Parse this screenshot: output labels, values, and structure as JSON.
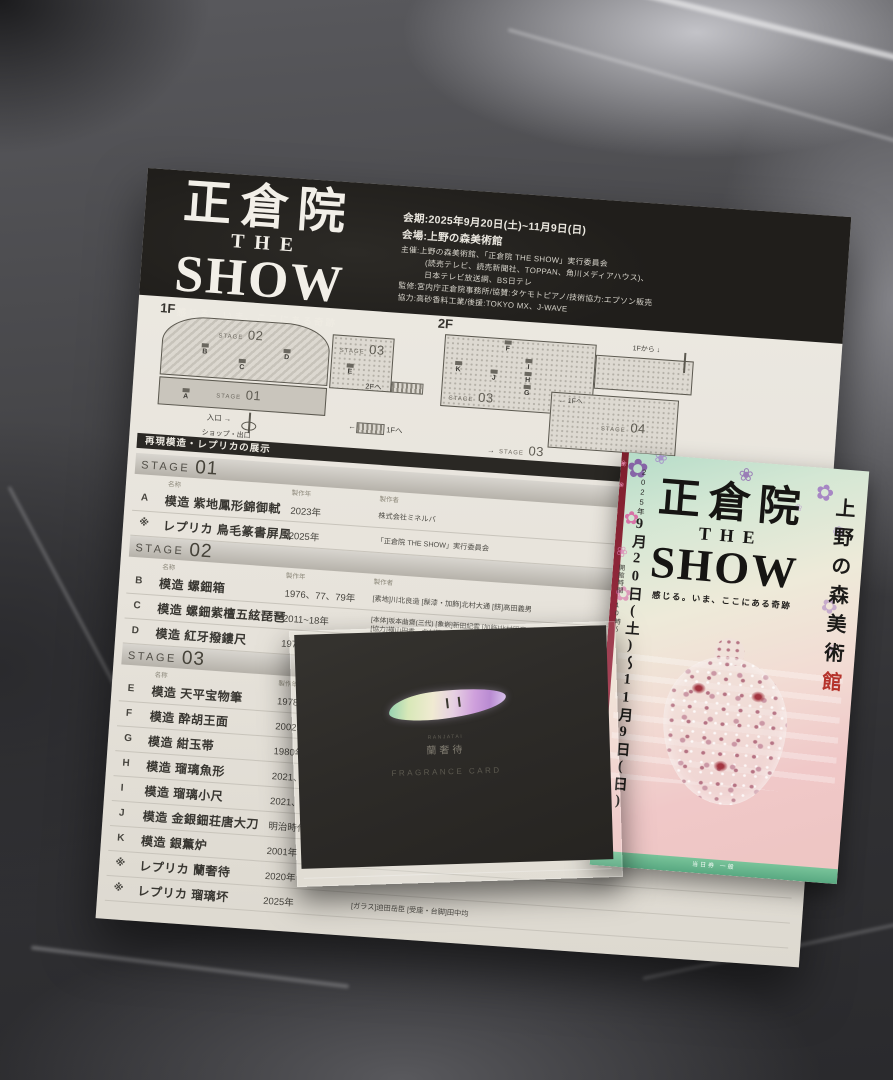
{
  "flyer": {
    "title": {
      "line1": "正倉院",
      "line2": "THE",
      "line3": "SHOW",
      "tagline": "感じる。いま、ここにある奇跡"
    },
    "info": {
      "lines": [
        "会期:2025年9月20日(土)~11月9日(日)",
        "会場:上野の森美術館",
        "主催:上野の森美術館、「正倉院 THE SHOW」実行委員会",
        "(読売テレビ、読売新聞社、TOPPAN、角川メディアハウス)、",
        "日本テレビ放送網、BS日テレ",
        "監修:宮内庁正倉院事務所/協賛:タケモトピアノ/技術協力:エプソン販売",
        "協力:高砂香料工業/後援:TOKYO MX、J-WAVE"
      ]
    },
    "floorplan": {
      "f1": "1F",
      "f2": "2F",
      "stage_word": "STAGE",
      "s01": "01",
      "s02": "02",
      "s03": "03",
      "s04": "04",
      "entrance": "入口",
      "shop_exit": "ショップ・出口",
      "to_2f": "2Fへ",
      "to_1f": "1Fへ",
      "from_1f": "1Fから",
      "arrow_r": "→",
      "arrow_l": "←",
      "arrow_d": "↓",
      "note": "※展示内容は一部変更になる可能性があります",
      "markers_1f": [
        {
          "t": "B",
          "x": 40,
          "y": 28
        },
        {
          "t": "C",
          "x": 78,
          "y": 41
        },
        {
          "t": "D",
          "x": 122,
          "y": 28
        },
        {
          "t": "E",
          "x": 186,
          "y": 38
        },
        {
          "t": "A",
          "x": 24,
          "y": 74
        }
      ],
      "markers_2f": [
        {
          "t": "F",
          "x": 66,
          "y": 8
        },
        {
          "t": "K",
          "x": 18,
          "y": 32
        },
        {
          "t": "J",
          "x": 54,
          "y": 38
        },
        {
          "t": "I",
          "x": 88,
          "y": 25
        },
        {
          "t": "H",
          "x": 88,
          "y": 38
        },
        {
          "t": "G",
          "x": 88,
          "y": 51
        }
      ]
    },
    "table": {
      "section_title": "再現模造・レプリカの展示",
      "stage_word": "STAGE",
      "col_name": "名称",
      "col_year": "製作年",
      "col_maker": "製作者",
      "stages": [
        {
          "num": "01",
          "rows": [
            {
              "key": "A",
              "name": "模造 紫地鳳形錦御軾",
              "year": "2023年",
              "maker": "株式会社ミネルバ"
            },
            {
              "key": "※",
              "name": "レプリカ 鳥毛篆書屏風",
              "year": "2025年",
              "maker": "「正倉院 THE SHOW」実行委員会"
            }
          ]
        },
        {
          "num": "02",
          "rows": [
            {
              "key": "B",
              "name": "模造 螺鈿箱",
              "year": "1976、77、79年",
              "maker": "[素地]川北良造 [髹漆・加飾]北村大通 [錺]高田義男"
            },
            {
              "key": "C",
              "name": "模造 螺鈿紫檀五絃琵琶",
              "year": "2011~18年",
              "maker": "[本体]坂本曲齋(三代) [象嵌]新田紀雲 [加飾]北村昭斎、松浦直子",
              "maker2": "[協力]横山円香、北村繁、西田孝雄、守田蔵、一般財団法人大日本蚕糸会"
            },
            {
              "key": "D",
              "name": "模造 紅牙撥鏤尺",
              "year": "1978年",
              "maker": ""
            }
          ]
        },
        {
          "num": "03",
          "rows": [
            {
              "key": "E",
              "name": "模造 天平宝物筆",
              "year": "1978年",
              "maker": ""
            },
            {
              "key": "F",
              "name": "模造 酔胡王面",
              "year": "2002、03年",
              "maker": ""
            },
            {
              "key": "G",
              "name": "模造 紺玉帯",
              "year": "1980年",
              "maker": ""
            },
            {
              "key": "H",
              "name": "模造 瑠璃魚形",
              "year": "2021、22年",
              "maker": ""
            },
            {
              "key": "I",
              "name": "模造 瑠璃小尺",
              "year": "2021、22年",
              "maker": ""
            },
            {
              "key": "J",
              "name": "模造 金銀鈿荘唐大刀",
              "year": "明治時代(",
              "maker": ""
            },
            {
              "key": "K",
              "name": "模造 銀薫炉",
              "year": "2001年",
              "maker": ""
            },
            {
              "key": "※",
              "name": "レプリカ 蘭奢待",
              "year": "2020年",
              "maker": ""
            },
            {
              "key": "※",
              "name": "レプリカ 瑠璃坏",
              "year": "2025年",
              "maker": "[ガラス]迫田岳臣 [受座・台脚]田中均"
            }
          ]
        }
      ]
    }
  },
  "envelope": {
    "furigana": "RANJATAI",
    "name": "蘭奢待",
    "caption": "FRAGRANCE CARD"
  },
  "ticket": {
    "title1": "正倉院",
    "title2": "THE",
    "title3": "SHOW",
    "tagline": "感じる。いま、ここにある奇跡",
    "venue_black": "上野の森美術",
    "venue_red": "館",
    "date_year": "2025年",
    "date_main": "9月20日(土)〜11月9日(日)",
    "hours": "開館時間 10時〜",
    "band_text": "当日券 一般",
    "decorations": [
      {
        "glyph": "✿",
        "x": 6,
        "y": 2,
        "s": 26,
        "c": "#7d4fa0",
        "o": 0.85,
        "r": 0
      },
      {
        "glyph": "❀",
        "x": 32,
        "y": -4,
        "s": 16,
        "c": "#a080c8",
        "o": 0.8,
        "r": 20
      },
      {
        "glyph": "❀",
        "x": 118,
        "y": 4,
        "s": 18,
        "c": "#8a5cae",
        "o": 0.75,
        "r": 0
      },
      {
        "glyph": "✿",
        "x": 196,
        "y": 14,
        "s": 22,
        "c": "#9a6fc0",
        "o": 0.8,
        "r": 15
      },
      {
        "glyph": "❁",
        "x": 216,
        "y": 56,
        "s": 15,
        "c": "#ab8ed2",
        "o": 0.7,
        "r": 0
      },
      {
        "glyph": "✿",
        "x": 210,
        "y": 128,
        "s": 20,
        "c": "#a77fc2",
        "o": 0.55,
        "r": 30
      },
      {
        "glyph": "❀",
        "x": 220,
        "y": 174,
        "s": 13,
        "c": "#b79bd6",
        "o": 0.5,
        "r": 0
      },
      {
        "glyph": "✿",
        "x": 7,
        "y": 56,
        "s": 18,
        "c": "#d9569c",
        "o": 0.8,
        "r": 0
      },
      {
        "glyph": "❀",
        "x": 2,
        "y": 92,
        "s": 14,
        "c": "#df7ab2",
        "o": 0.7,
        "r": 25
      },
      {
        "glyph": "✿",
        "x": 4,
        "y": 132,
        "s": 20,
        "c": "#d867a6",
        "o": 0.6,
        "r": 0
      },
      {
        "glyph": "❀",
        "x": 176,
        "y": 38,
        "s": 10,
        "c": "#b490cc",
        "o": 0.6,
        "r": 0
      },
      {
        "glyph": "❀",
        "x": 58,
        "y": 26,
        "s": 9,
        "c": "#c4a4da",
        "o": 0.5,
        "r": 0
      },
      {
        "glyph": "✾",
        "x": 226,
        "y": 208,
        "s": 12,
        "c": "#c39ed0",
        "o": 0.45,
        "r": 0
      },
      {
        "glyph": "❀",
        "x": -1,
        "y": 8,
        "s": 8,
        "c": "#e589ad",
        "o": 0.9,
        "r": 0
      },
      {
        "glyph": "❀",
        "x": -1,
        "y": 30,
        "s": 7,
        "c": "#e589ad",
        "o": 0.85,
        "r": 0
      }
    ]
  },
  "colors": {
    "accent_red": "#b5332c",
    "band_green": "#67b890",
    "envelope": "#2d2b28",
    "paper": "#e7e3db"
  }
}
